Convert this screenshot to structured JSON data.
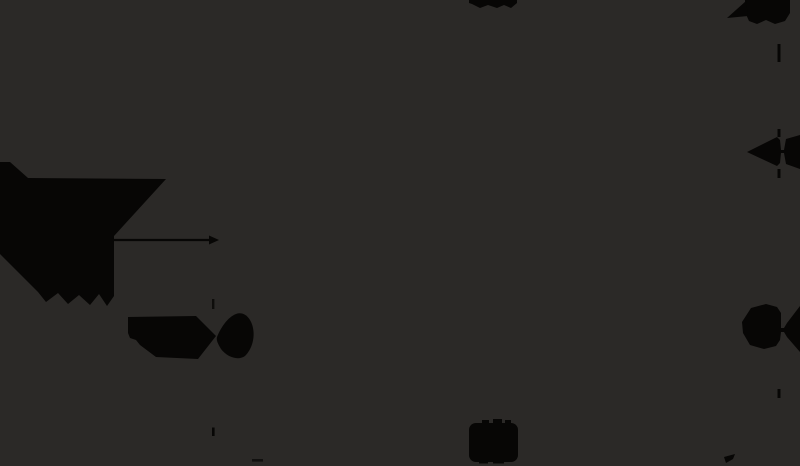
{
  "canvas": {
    "width": 800,
    "height": 466,
    "background": "#2b2927",
    "ink": "#070605"
  },
  "drawing": {
    "shapes": [
      {
        "name": "solid-wedge-shape",
        "kind": "polygon",
        "points": "0,162 10,162 28,178 166,179 114,236 114,296 107,306 99,294 90,305 79,295 68,304 58,293 46,302 38,292 0,254"
      },
      {
        "name": "dimension-line-horizontal",
        "kind": "line",
        "x1": 113,
        "y1": 240,
        "x2": 210,
        "y2": 240,
        "w": 2.2
      },
      {
        "name": "dimension-arrowhead-right",
        "kind": "polygon",
        "points": "209,235.5 219,240 209,244.5"
      },
      {
        "name": "extension-dash-center-upper",
        "kind": "rect",
        "x": 212,
        "y": 299,
        "w": 2.4,
        "h": 10,
        "opacity": 0.8
      },
      {
        "name": "extension-tick-center-lower",
        "kind": "rect",
        "x": 212,
        "y": 427.5,
        "w": 2.6,
        "h": 8.5
      },
      {
        "name": "bowtie-arrow-left-west-half",
        "kind": "polygon",
        "points": "128,317 196,316 216,336 198,359 156,357 140,345 136,340 130,338 128,333"
      },
      {
        "name": "bowtie-arrow-left-east-half",
        "kind": "path",
        "d": "M217,337 C221,327 228,317 236,314 C244,311 251,318 253,328 C255,338 252,349 245,356 C238,361 227,357 221,349 C218,344 216,340 217,337 Z"
      },
      {
        "name": "double-arrow-right-middle",
        "kind": "path",
        "d": "M747,152 L777,137 L780,140 L781,150 L784,150 L786,139 L800,135 L800,169 L786,164 L784,153 L781,153 L780,163 L777,166 Z"
      },
      {
        "name": "double-arrow-right-lower",
        "kind": "path",
        "d": "M742,322 L751,308 L766,304 L777,307 L781,313 L781,328 L784,328 L787,323 L800,306 L800,352 L787,337 L784,332 L781,332 L780,340 L776,346 L764,349 L750,345 L743,333 Z"
      },
      {
        "name": "top-right-label-blob",
        "kind": "polygon",
        "points": "745,0 790,0 790,13 785,21 775,24 766,20 757,24 749,21 745,12"
      },
      {
        "name": "top-right-arrow-protrusion",
        "kind": "polygon",
        "points": "746,1 748,16 727,18"
      },
      {
        "name": "right-extension-dashed-line",
        "kind": "vdashes",
        "x": 777.5,
        "w": 3,
        "dashes": [
          [
            44,
            18
          ],
          [
            129,
            8
          ],
          [
            169,
            9
          ],
          [
            389,
            9
          ]
        ]
      },
      {
        "name": "top-center-label-blob",
        "kind": "polygon",
        "points": "469,0 517,0 517,3 511,8 504,5 497,8 488,5 480,8 472,4 469,3"
      },
      {
        "name": "bottom-center-label-blob",
        "kind": "rect",
        "x": 469,
        "y": 423,
        "w": 49,
        "h": 39,
        "rx": 7
      },
      {
        "name": "bottom-center-label-bump-1",
        "kind": "rect",
        "x": 482,
        "y": 420,
        "w": 7,
        "h": 5
      },
      {
        "name": "bottom-center-label-bump-2",
        "kind": "rect",
        "x": 493,
        "y": 419,
        "w": 9,
        "h": 6
      },
      {
        "name": "bottom-center-label-bump-3",
        "kind": "rect",
        "x": 505,
        "y": 420,
        "w": 6,
        "h": 5
      },
      {
        "name": "bottom-center-label-bump-4",
        "kind": "rect",
        "x": 479,
        "y": 460,
        "w": 9,
        "h": 3.5
      },
      {
        "name": "bottom-center-label-bump-5",
        "kind": "rect",
        "x": 493,
        "y": 460,
        "w": 11,
        "h": 3.5
      },
      {
        "name": "bottom-center-smudge",
        "kind": "rect",
        "x": 252,
        "y": 459,
        "w": 11,
        "h": 2.6,
        "opacity": 0.7
      },
      {
        "name": "bottom-right-small-mark",
        "kind": "polygon",
        "points": "724,457 735,454 733,459 726,463"
      }
    ]
  }
}
